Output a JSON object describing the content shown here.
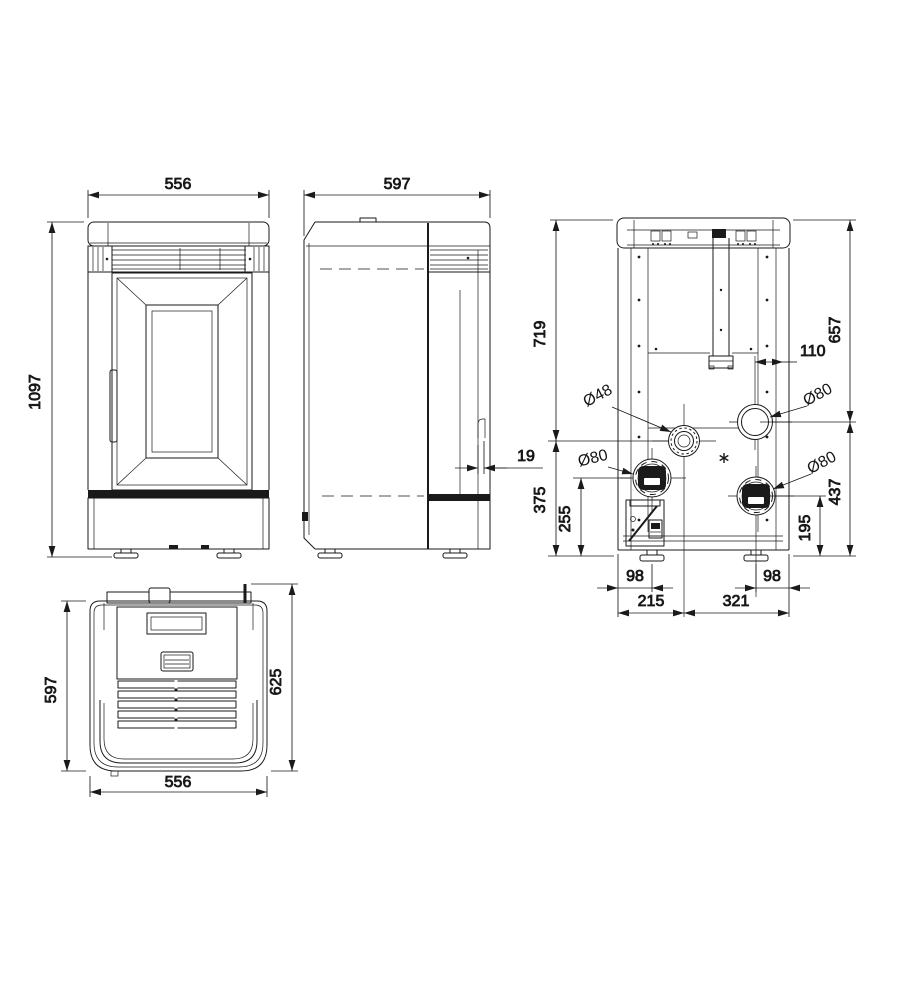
{
  "drawing": {
    "type": "technical-dimension-drawing",
    "colors": {
      "line": "#1a1a1a",
      "background": "#ffffff"
    },
    "dims": {
      "front_width": "556",
      "front_height": "1097",
      "side_depth": "597",
      "rear_clearance": "19",
      "rear_left_upper": "719",
      "rear_left_lower": "375",
      "rear_left_port_height": "255",
      "rear_right_upper": "657",
      "rear_right_lower": "437",
      "rear_right_port_height": "195",
      "rear_port_offset": "110",
      "rear_foot_left": "98",
      "rear_span_left": "215",
      "rear_span_right": "321",
      "rear_foot_right": "98",
      "flue_diameter": "Ø48",
      "port_left_diameter": "Ø80",
      "port_top_right_diameter": "Ø80",
      "port_bottom_right_diameter": "Ø80",
      "top_depth": "597",
      "top_total_depth": "625",
      "top_width": "556"
    }
  }
}
